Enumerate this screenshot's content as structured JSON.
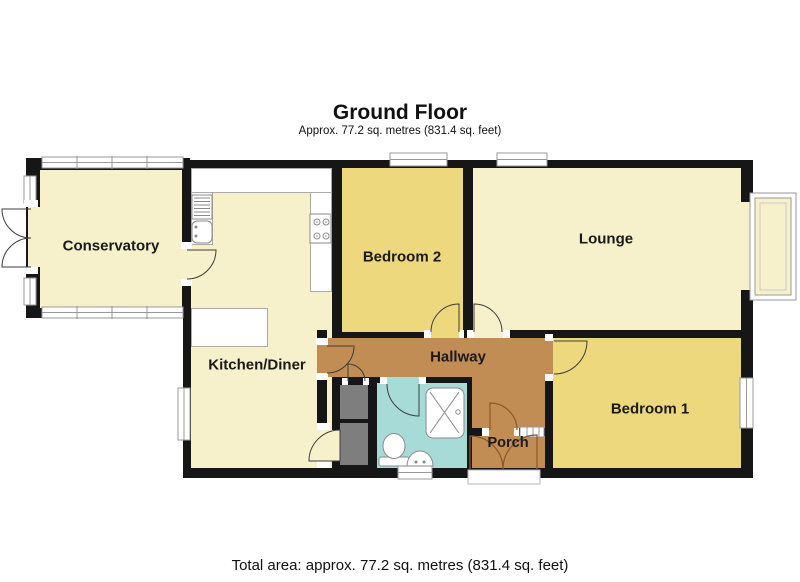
{
  "header": {
    "title": "Ground Floor",
    "subtitle": "Approx. 77.2 sq. metres (831.4 sq. feet)"
  },
  "rooms": {
    "conservatory": {
      "label": "Conservatory"
    },
    "kitchen_diner": {
      "label": "Kitchen/Diner"
    },
    "bedroom2": {
      "label": "Bedroom 2"
    },
    "lounge": {
      "label": "Lounge"
    },
    "hallway": {
      "label": "Hallway"
    },
    "bedroom1": {
      "label": "Bedroom 1"
    },
    "porch": {
      "label": "Porch"
    }
  },
  "footer": {
    "total_area": "Total area: approx. 77.2 sq. metres (831.4 sq. feet)"
  },
  "colors": {
    "wall": "#161616",
    "cream": "#F6F1CB",
    "gold": "#EDD87E",
    "orange": "#C18D54",
    "teal": "#A6DBD7",
    "cupboard": "#7E7E7E",
    "frame": "#999999",
    "fixture": "#8A8A8A",
    "arc": "#3C3C3C",
    "porch_arc": "#8A5A28"
  }
}
